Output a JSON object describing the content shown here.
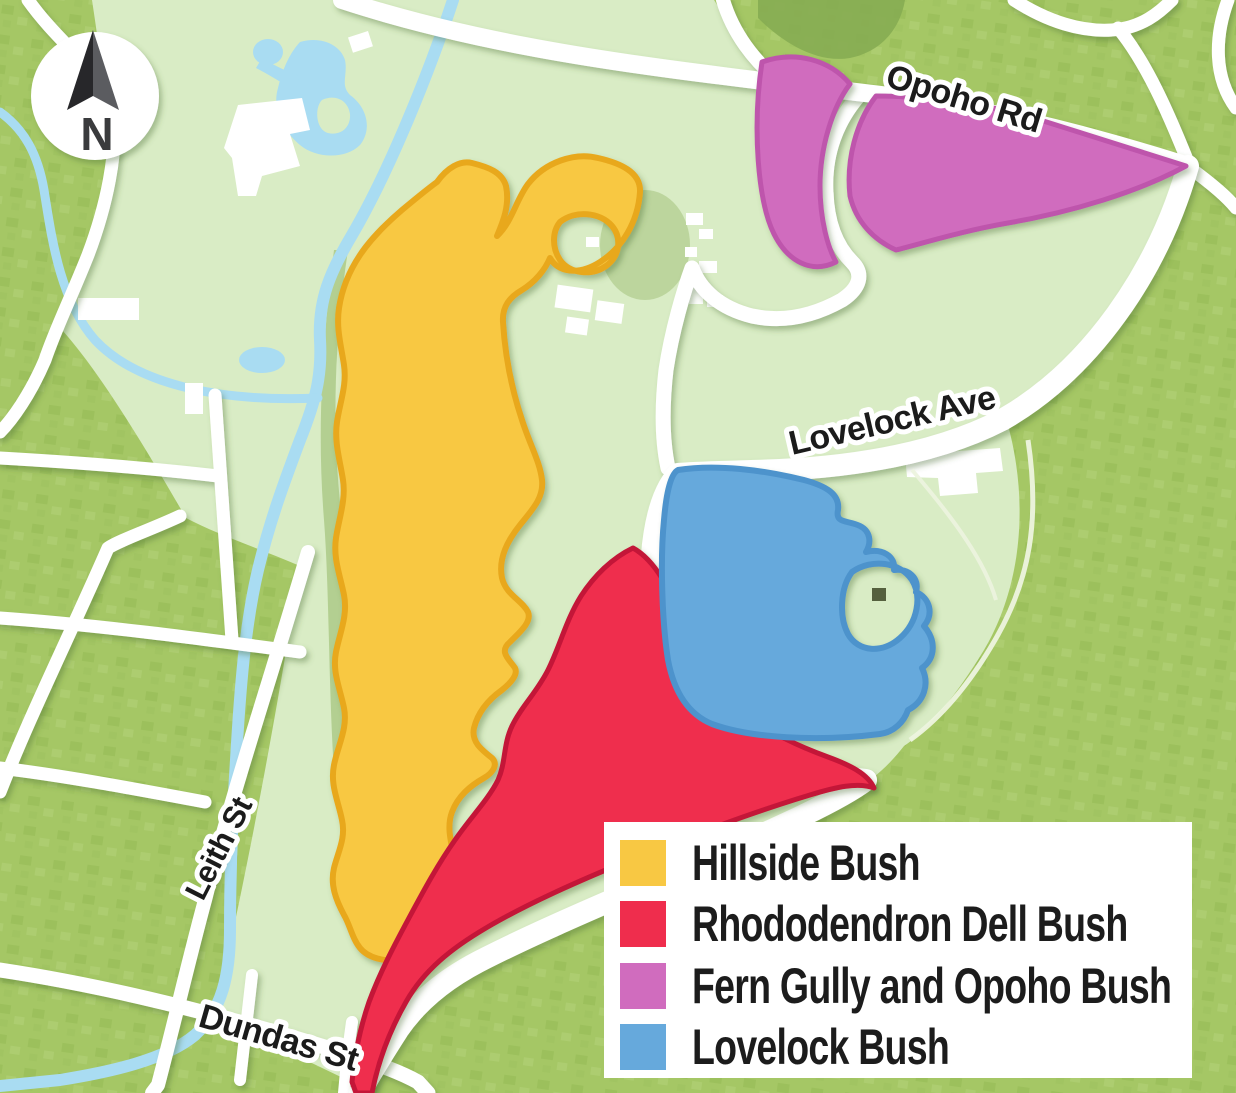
{
  "street_labels": {
    "opoho": "Opoho Rd",
    "lovelock": "Lovelock Ave",
    "leith": "Leith St",
    "dundas": "Dundas St"
  },
  "compass": {
    "label": "N"
  },
  "regions": [
    {
      "label": "Hillside Bush",
      "color": "#F8C843",
      "stroke": "#E8A81E"
    },
    {
      "label": "Rhododendron Dell Bush",
      "color": "#EF2D4D",
      "stroke": "#C31238"
    },
    {
      "label": "Fern Gully and Opoho Bush",
      "color": "#D06CBE",
      "stroke": "#BE55AC"
    },
    {
      "label": "Lovelock Bush",
      "color": "#66A9DC",
      "stroke": "#4D93CC"
    }
  ],
  "map_colors": {
    "base_green": "#A5C765",
    "park_green": "#D9ECC5",
    "forest_green": "#86AC52",
    "water_blue": "#A9DCF2",
    "road_white": "#FFFFFF"
  }
}
